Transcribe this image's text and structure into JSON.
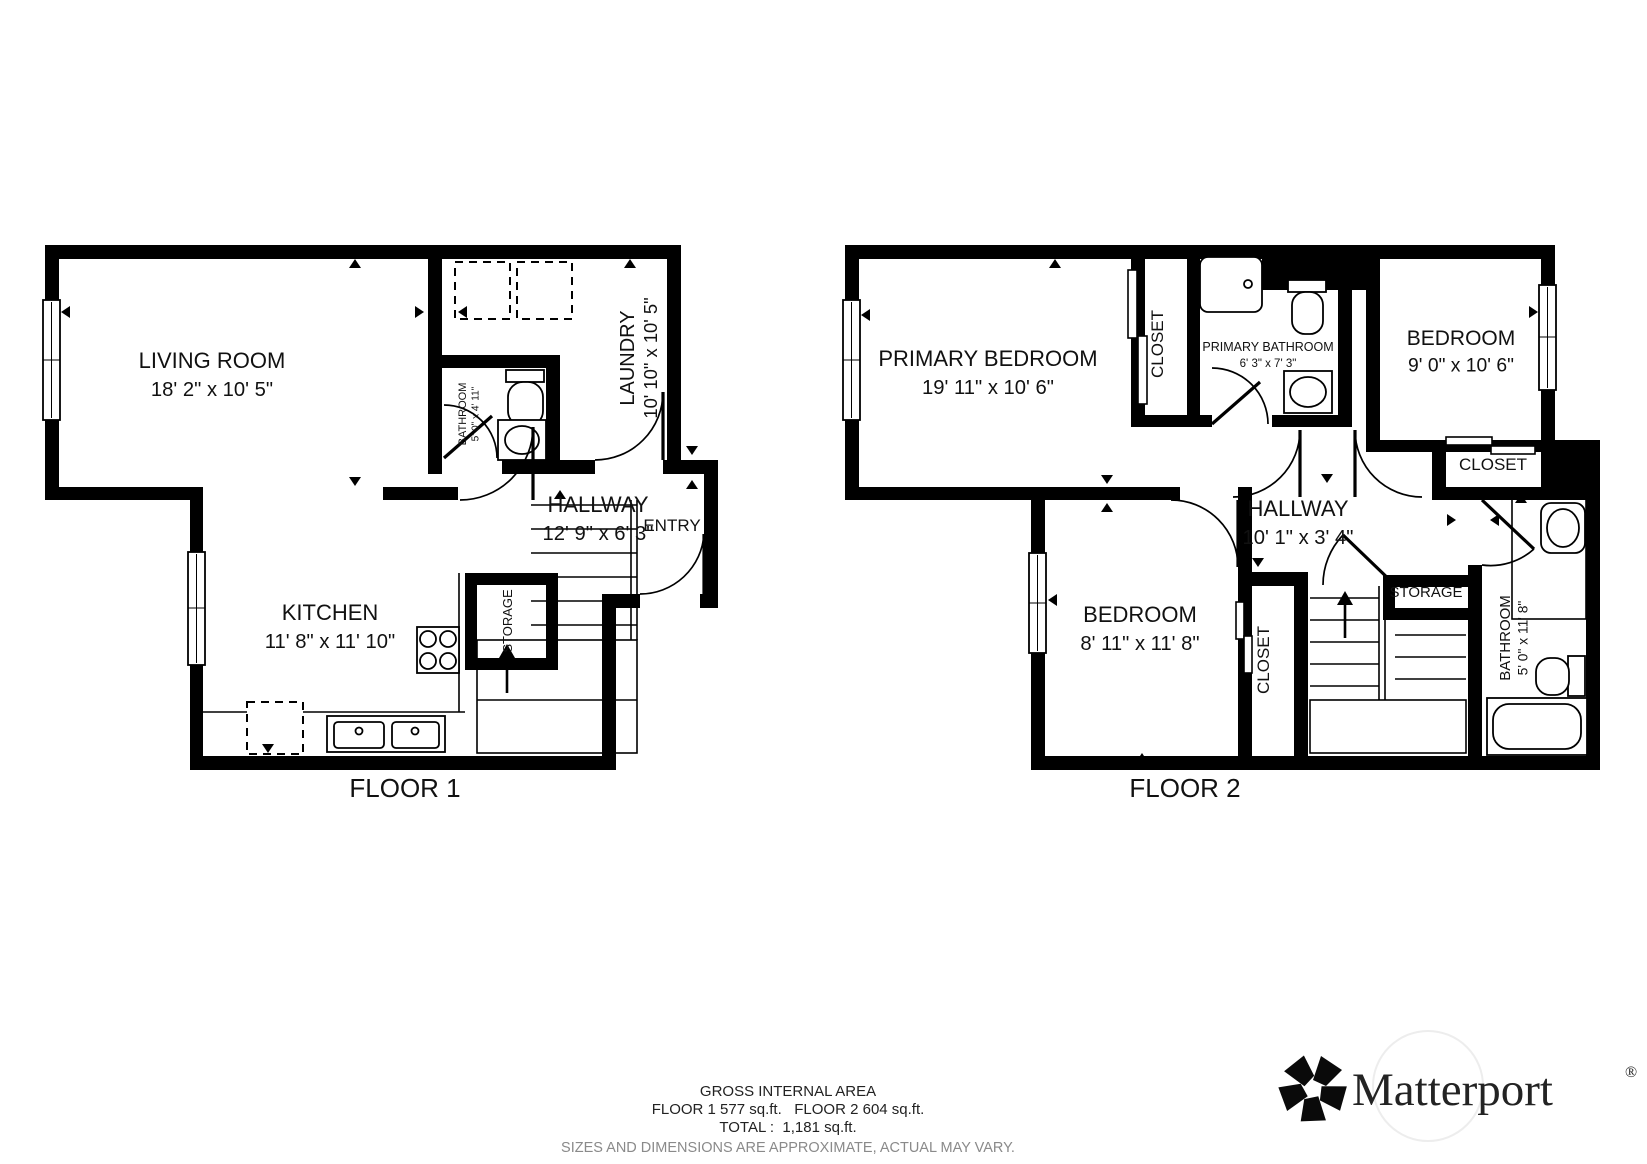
{
  "captions": {
    "floor1": "FLOOR 1",
    "floor2": "FLOOR 2"
  },
  "footer": {
    "line1": "GROSS INTERNAL AREA",
    "line2": "FLOOR 1 577 sq.ft.   FLOOR 2 604 sq.ft.",
    "line3": "TOTAL :  1,181 sq.ft.",
    "line4": "SIZES AND DIMENSIONS ARE APPROXIMATE, ACTUAL MAY VARY."
  },
  "logo": {
    "text": "Matterport",
    "registered": "®"
  },
  "floors": [
    {
      "id": "floor1",
      "rooms": [
        {
          "name": "LIVING ROOM",
          "dims": "18' 2\" x 10' 5\"",
          "x": 212,
          "y": 368,
          "rot": 0,
          "size": 22
        },
        {
          "name": "KITCHEN",
          "dims": "11' 8\" x 11' 10\"",
          "x": 330,
          "y": 620,
          "rot": 0,
          "size": 22
        },
        {
          "name": "HALLWAY",
          "dims": "12' 9\" x 6' 3\"",
          "x": 598,
          "y": 512,
          "rot": 0,
          "size": 22
        },
        {
          "name": "ENTRY",
          "dims": "",
          "x": 672,
          "y": 531,
          "rot": 0,
          "size": 17
        },
        {
          "name": "LAUNDRY",
          "dims": "10' 10\" x 10' 5\"",
          "x": 634,
          "y": 358,
          "rot": -90,
          "size": 20
        },
        {
          "name": "BATHROOM",
          "dims": "5' 0\" x 4' 11\"",
          "x": 466,
          "y": 414,
          "rot": -90,
          "size": 11
        },
        {
          "name": "STORAGE",
          "dims": "",
          "x": 512,
          "y": 621,
          "rot": -90,
          "size": 13
        }
      ]
    },
    {
      "id": "floor2",
      "rooms": [
        {
          "name": "PRIMARY BEDROOM",
          "dims": "19' 11\" x 10' 6\"",
          "x": 988,
          "y": 366,
          "rot": 0,
          "size": 22
        },
        {
          "name": "BEDROOM",
          "dims": "9' 0\" x 10' 6\"",
          "x": 1461,
          "y": 345,
          "rot": 0,
          "size": 21
        },
        {
          "name": "BEDROOM",
          "dims": "8' 11\" x 11' 8\"",
          "x": 1140,
          "y": 622,
          "rot": 0,
          "size": 22
        },
        {
          "name": "HALLWAY",
          "dims": "10' 1\" x 3' 4\"",
          "x": 1298,
          "y": 516,
          "rot": 0,
          "size": 22
        },
        {
          "name": "PRIMARY BATHROOM",
          "dims": "6' 3\" x 7' 3\"",
          "x": 1268,
          "y": 351,
          "rot": 0,
          "size": 12.5
        },
        {
          "name": "CLOSET",
          "dims": "",
          "x": 1163,
          "y": 344,
          "rot": -90,
          "size": 17
        },
        {
          "name": "CLOSET",
          "dims": "",
          "x": 1493,
          "y": 470,
          "rot": 0,
          "size": 17
        },
        {
          "name": "CLOSET",
          "dims": "",
          "x": 1269,
          "y": 660,
          "rot": -90,
          "size": 17
        },
        {
          "name": "STORAGE",
          "dims": "",
          "x": 1426,
          "y": 597,
          "rot": 0,
          "size": 15
        },
        {
          "name": "BATHROOM",
          "dims": "5' 0\" x 11' 8\"",
          "x": 1510,
          "y": 638,
          "rot": -90,
          "size": 15
        }
      ]
    }
  ]
}
